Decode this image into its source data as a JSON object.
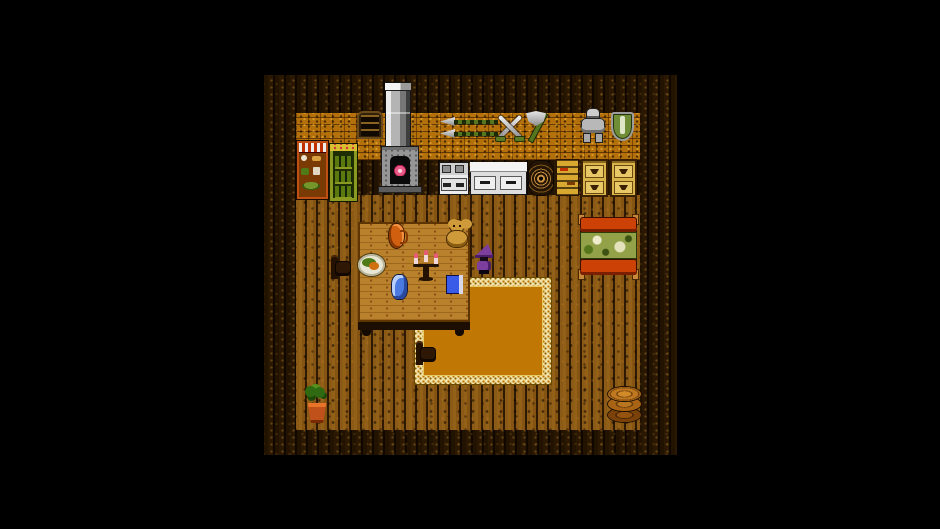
{
  "scene": {
    "name": "retro-rpg-house-interior",
    "viewport_label": "game scene: wooden house interior with furnace, weapon wall, kitchen, table and bed",
    "colors": {
      "background": "#000000",
      "floor_wood": "#8a5a16",
      "border_planks": "#2a1802",
      "brick_wall": "#b4700a",
      "table_wood": "#b9812b",
      "rug_center": "#c17703",
      "rug_border": "#f0e2a8",
      "bed_frame": "#cc4206",
      "blanket_green": "#93a248",
      "wizard_purple": "#7d3f9e",
      "metal_grey": "#b8b8b8",
      "weapon_green": "#55761f",
      "appliance_white": "#ececec",
      "dresser_tan": "#d9b44a",
      "shelf_yellow": "#d8a830",
      "pantry_red": "#bf4f12",
      "cabinet_olive": "#8a9a20",
      "fire_pink": "#e85a8a",
      "jar_blue": "#4a7ae0",
      "book_blue": "#3a5ae8",
      "jug_orange": "#d06010",
      "pot_terracotta": "#c0511a",
      "leaf_green": "#2f6a12"
    },
    "objects": {
      "viewport": {
        "label": "game viewport"
      },
      "chimney": {
        "label": "chimney pipe"
      },
      "furnace": {
        "label": "stone furnace with fire"
      },
      "wall_window": {
        "label": "shuttered wall window"
      },
      "spears": {
        "label": "two spears on wall"
      },
      "crossed_swords": {
        "label": "crossed swords on wall"
      },
      "axe": {
        "label": "battle axe on wall"
      },
      "armor": {
        "label": "suit of armor on wall"
      },
      "shield": {
        "label": "green shield on wall"
      },
      "pantry": {
        "label": "pantry shelf with food"
      },
      "bottle_cabinet": {
        "label": "green cabinet with bottles"
      },
      "stove": {
        "label": "cooking stove"
      },
      "counter": {
        "label": "kitchen counter with drawers"
      },
      "basket": {
        "label": "coiled basket"
      },
      "ladder_shelf": {
        "label": "slatted shelf"
      },
      "dresser_left": {
        "label": "drawer dresser"
      },
      "dresser_right": {
        "label": "drawer dresser"
      },
      "rug": {
        "label": "orange rug with patterned border"
      },
      "table": {
        "label": "large wooden table"
      },
      "chair_left": {
        "label": "wooden chair"
      },
      "chair_rug": {
        "label": "wooden chair on rug"
      },
      "jug": {
        "label": "clay jug"
      },
      "teddy_bear": {
        "label": "teddy bear"
      },
      "plate": {
        "label": "plate of food"
      },
      "candelabra": {
        "label": "candelabra with three candles"
      },
      "jar": {
        "label": "blue jar"
      },
      "book": {
        "label": "blue book"
      },
      "wizard": {
        "label": "purple-hooded character"
      },
      "bed": {
        "label": "bed with green blanket"
      },
      "plant": {
        "label": "potted plant"
      },
      "log_stool": {
        "label": "stack of logs"
      }
    }
  }
}
